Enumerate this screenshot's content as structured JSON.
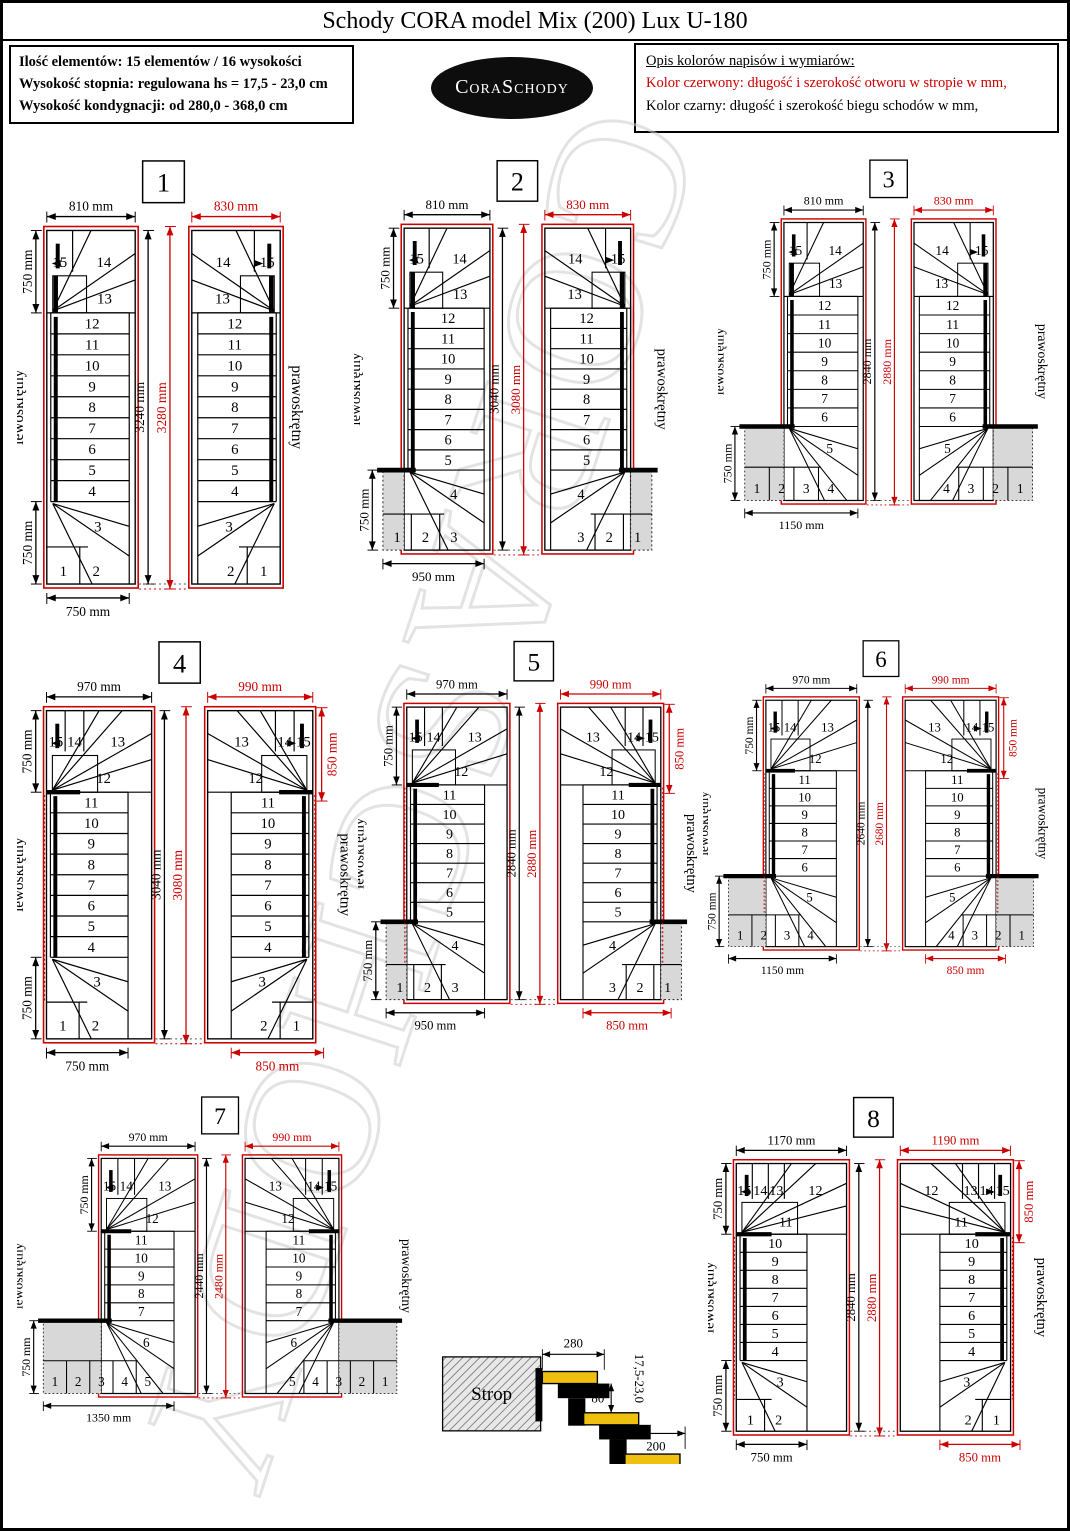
{
  "header": {
    "title": "Schody CORA model Mix (200) Lux U-180"
  },
  "info_box": {
    "lines": [
      "Ilość elementów: 15 elementów / 16 wysokości",
      "Wysokość stopnia: regulowana  hs = 17,5 - 23,0 cm",
      "Wysokość kondygnacji: od 280,0 - 368,0 cm"
    ]
  },
  "logo": {
    "part1": "Cora",
    "part2": "Schody"
  },
  "legend": {
    "heading": "Opis kolorów napisów i wymiarów:",
    "red_line": "Kolor czerwony: długość i szerokość otworu w stropie w mm,",
    "black_line": "Kolor czarny: długość i szerokość biegu schodów w mm,"
  },
  "watermark": {
    "text": "CORASCHODY"
  },
  "plan_labels": {
    "left": "lewoskrętny",
    "right": "prawoskrętny"
  },
  "colors": {
    "red": "#cc0000",
    "gray_fill": "#d8d8d8",
    "tread_yellow": "#f0c011"
  },
  "diagrams": [
    {
      "number": "1",
      "top_width_black": "810 mm",
      "top_width_red": "830 mm",
      "left_top": "750 mm",
      "left_bottom": "750 mm",
      "height_black": "3240 mm",
      "height_red": "3280 mm",
      "bottom_width_black": "750 mm",
      "bottom_width_red": "",
      "side_right_red": "",
      "steps_top_row": [
        "15",
        "14"
      ],
      "step_below_top": "13",
      "flight_steps": [
        "12",
        "11",
        "10",
        "9",
        "8",
        "7",
        "6",
        "5",
        "4"
      ],
      "step_above_bottom": "3",
      "bottom_row": [
        "1",
        "2"
      ]
    },
    {
      "number": "2",
      "top_width_black": "810 mm",
      "top_width_red": "830 mm",
      "left_top": "750 mm",
      "left_bottom": "750 mm",
      "height_black": "3040 mm",
      "height_red": "3080 mm",
      "bottom_width_black": "950 mm",
      "bottom_width_red": "",
      "side_right_red": "",
      "steps_top_row": [
        "15",
        "14"
      ],
      "step_below_top": "13",
      "flight_steps": [
        "12",
        "11",
        "10",
        "9",
        "8",
        "7",
        "6",
        "5"
      ],
      "step_above_bottom": "4",
      "bottom_row": [
        "1",
        "2",
        "3"
      ]
    },
    {
      "number": "3",
      "top_width_black": "810 mm",
      "top_width_red": "830 mm",
      "left_top": "750 mm",
      "left_bottom": "750 mm",
      "height_black": "2840 mm",
      "height_red": "2880 mm",
      "bottom_width_black": "1150 mm",
      "bottom_width_red": "",
      "side_right_red": "",
      "steps_top_row": [
        "15",
        "14"
      ],
      "step_below_top": "13",
      "flight_steps": [
        "12",
        "11",
        "10",
        "9",
        "8",
        "7",
        "6"
      ],
      "step_above_bottom": "5",
      "bottom_row": [
        "1",
        "2",
        "3",
        "4"
      ]
    },
    {
      "number": "4",
      "top_width_black": "970 mm",
      "top_width_red": "990 mm",
      "left_top": "750 mm",
      "left_bottom": "750 mm",
      "height_black": "3040 mm",
      "height_red": "3080 mm",
      "bottom_width_black": "750 mm",
      "bottom_width_red": "850 mm",
      "side_right_red": "850 mm",
      "steps_top_row": [
        "15",
        "14",
        "13"
      ],
      "step_below_top": "12",
      "flight_steps": [
        "11",
        "10",
        "9",
        "8",
        "7",
        "6",
        "5",
        "4"
      ],
      "step_above_bottom": "3",
      "bottom_row": [
        "1",
        "2"
      ]
    },
    {
      "number": "5",
      "top_width_black": "970 mm",
      "top_width_red": "990 mm",
      "left_top": "750 mm",
      "left_bottom": "750 mm",
      "height_black": "2840 mm",
      "height_red": "2880 mm",
      "bottom_width_black": "950 mm",
      "bottom_width_red": "850 mm",
      "side_right_red": "850 mm",
      "steps_top_row": [
        "15",
        "14",
        "13"
      ],
      "step_below_top": "12",
      "flight_steps": [
        "11",
        "10",
        "9",
        "8",
        "7",
        "6",
        "5"
      ],
      "step_above_bottom": "4",
      "bottom_row": [
        "1",
        "2",
        "3"
      ]
    },
    {
      "number": "6",
      "top_width_black": "970 mm",
      "top_width_red": "990 mm",
      "left_top": "750 mm",
      "left_bottom": "750 mm",
      "height_black": "2640 mm",
      "height_red": "2680 mm",
      "bottom_width_black": "1150 mm",
      "bottom_width_red": "850 mm",
      "side_right_red": "850 mm",
      "steps_top_row": [
        "15",
        "14",
        "13"
      ],
      "step_below_top": "12",
      "flight_steps": [
        "11",
        "10",
        "9",
        "8",
        "7",
        "6"
      ],
      "step_above_bottom": "5",
      "bottom_row": [
        "1",
        "2",
        "3",
        "4"
      ]
    },
    {
      "number": "7",
      "top_width_black": "970 mm",
      "top_width_red": "990 mm",
      "left_top": "750 mm",
      "left_bottom": "750 mm",
      "height_black": "2440 mm",
      "height_red": "2480 mm",
      "bottom_width_black": "1350 mm",
      "bottom_width_red": "",
      "side_right_red": "",
      "steps_top_row": [
        "15",
        "14",
        "13"
      ],
      "step_below_top": "12",
      "flight_steps": [
        "11",
        "10",
        "9",
        "8",
        "7"
      ],
      "step_above_bottom": "6",
      "bottom_row": [
        "1",
        "2",
        "3",
        "4",
        "5"
      ]
    },
    {
      "number": "8",
      "top_width_black": "1170 mm",
      "top_width_red": "1190 mm",
      "left_top": "750 mm",
      "left_bottom": "750 mm",
      "height_black": "2840 mm",
      "height_red": "2880 mm",
      "bottom_width_black": "750 mm",
      "bottom_width_red": "850 mm",
      "side_right_red": "850 mm",
      "steps_top_row": [
        "15",
        "14",
        "13",
        "12"
      ],
      "step_below_top": "11",
      "flight_steps": [
        "10",
        "9",
        "8",
        "7",
        "6",
        "5",
        "4"
      ],
      "step_above_bottom": "3",
      "bottom_row": [
        "1",
        "2"
      ]
    }
  ],
  "side_view": {
    "strop_label": "Strop",
    "tread_depth": "280",
    "nosing_overlap": "80",
    "tread_length": "200",
    "riser_range": "17,5-23,0"
  }
}
